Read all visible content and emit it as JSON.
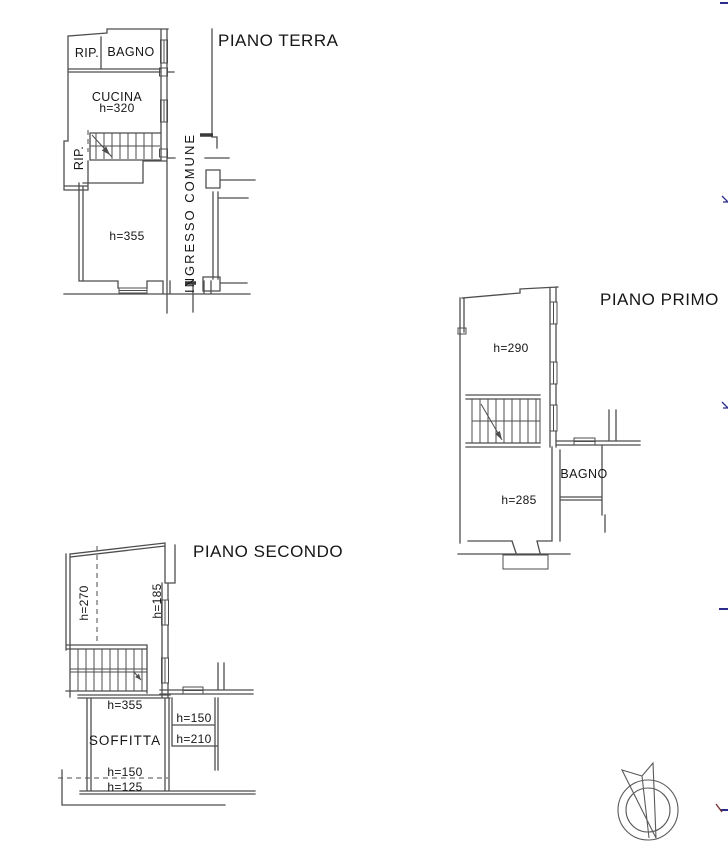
{
  "drawing": {
    "background": "#ffffff",
    "line_color": "#4e4e4e",
    "text_color": "#161616",
    "mark_blue": "#2b2b8c",
    "mark_red": "#7a3535"
  },
  "piano_terra": {
    "title": "PIANO TERRA",
    "rip_top_label": "RIP.",
    "bagno_label": "BAGNO",
    "cucina_label": "CUCINA",
    "cucina_height": "h=320",
    "rip_side_label": "RIP.",
    "main_room_height": "h=355",
    "corridor_label": "INGRESSO COMUNE"
  },
  "piano_primo": {
    "title": "PIANO PRIMO",
    "upper_room_height": "h=290",
    "lower_room_height": "h=285",
    "bagno_label": "BAGNO"
  },
  "piano_secondo": {
    "title": "PIANO SECONDO",
    "left_area_height": "h=270",
    "right_area_height": "h=185",
    "stair_room_height": "h=355",
    "soffitta_label": "SOFFITTA",
    "closet_height_1": "h=150",
    "closet_height_2": "h=210",
    "soffitta_height_1": "h=150",
    "soffitta_height_2": "h=125"
  }
}
